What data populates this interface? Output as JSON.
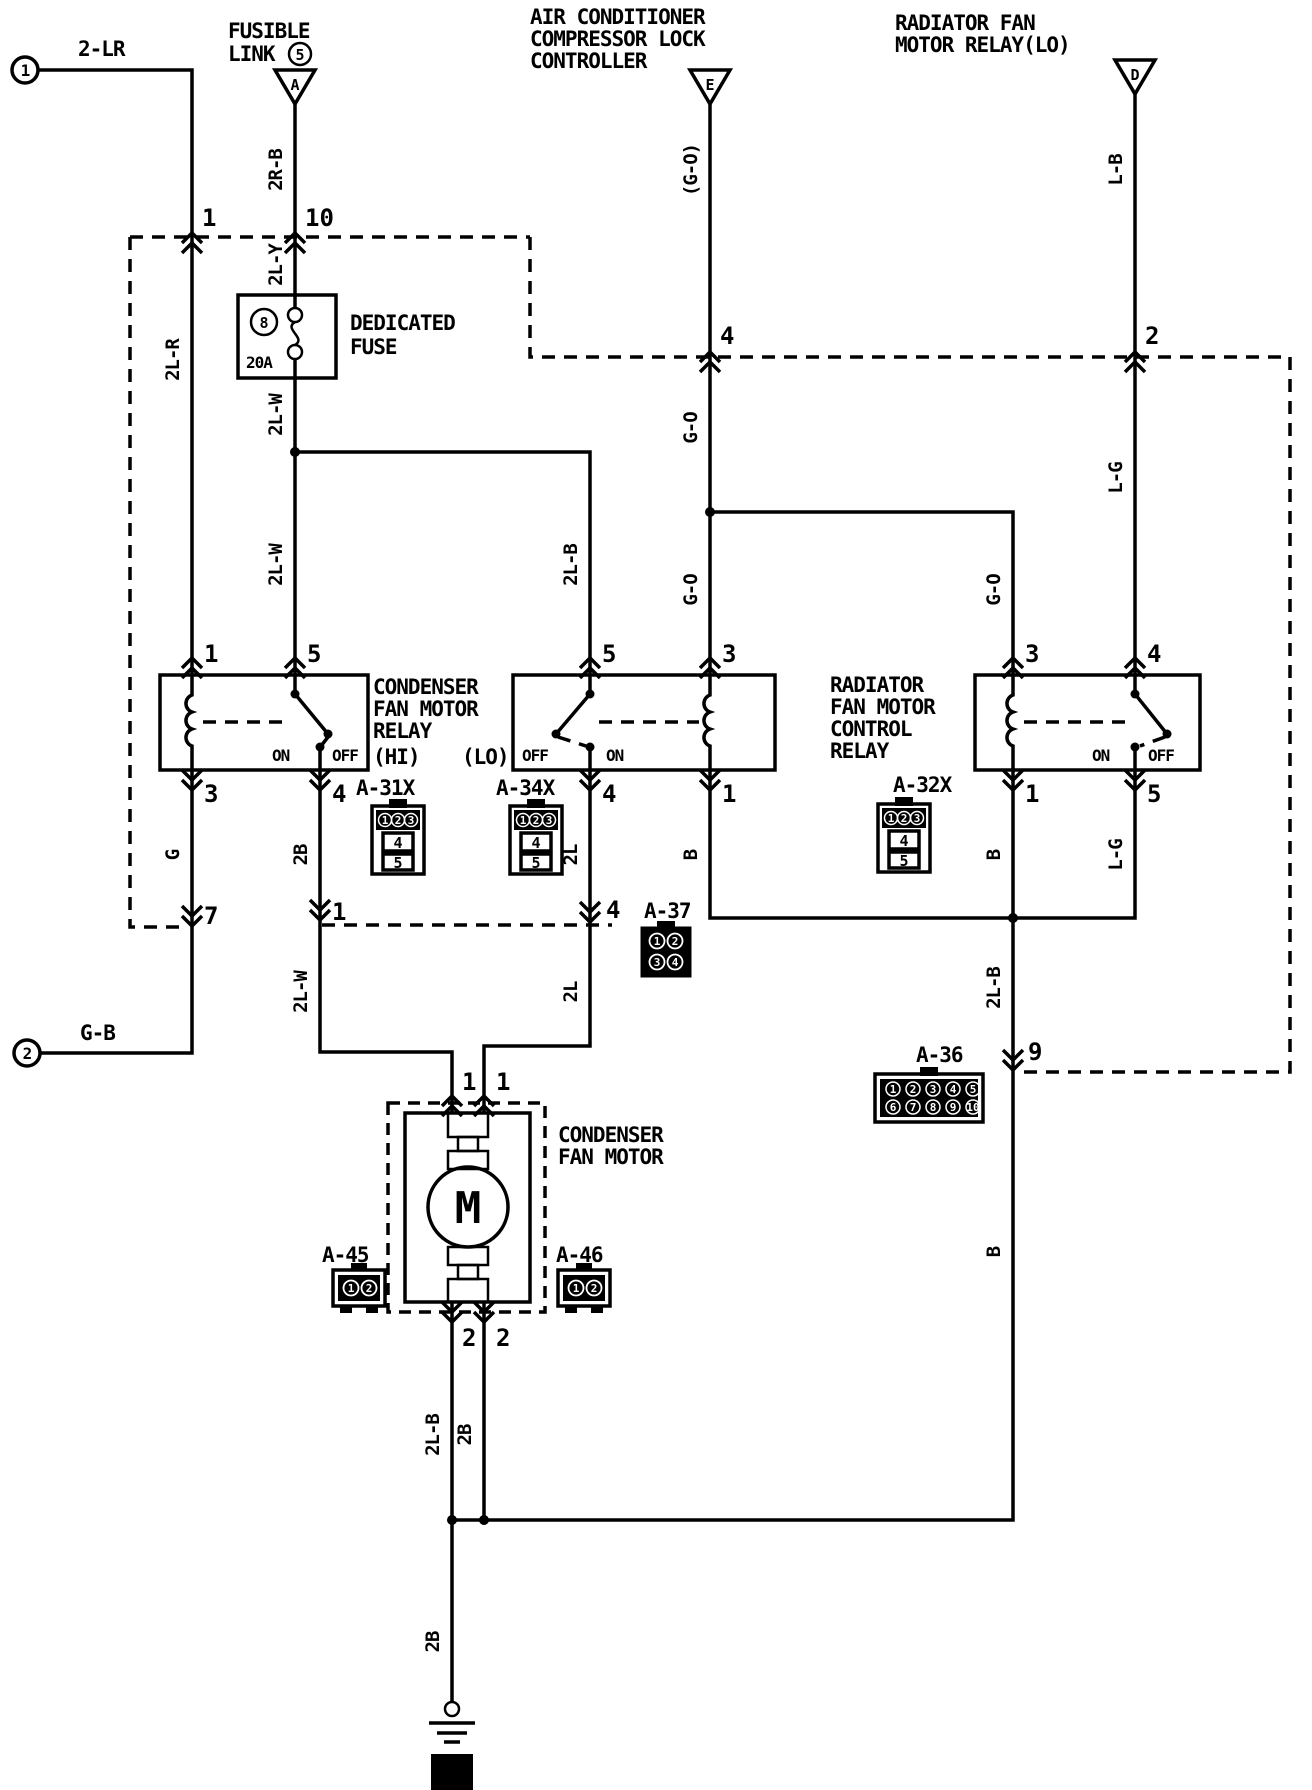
{
  "page": {
    "ref_number": "4"
  },
  "terminals": {
    "t1": "1",
    "t2": "2"
  },
  "titles": {
    "fusible_1": "FUSIBLE",
    "fusible_2": "LINK",
    "fusible_num": "5",
    "tri_a": "A",
    "ac_1": "AIR CONDITIONER",
    "ac_2": "COMPRESSOR LOCK",
    "ac_3": "CONTROLLER",
    "tri_e": "E",
    "rad_1": "RADIATOR FAN",
    "rad_2": "MOTOR RELAY(LO)",
    "tri_d": "D"
  },
  "fuse": {
    "l1": "DEDICATED",
    "l2": "FUSE",
    "num": "8",
    "amp": "20A"
  },
  "relay_condenser": {
    "l1": "CONDENSER",
    "l2": "FAN MOTOR",
    "l3": "RELAY",
    "hi": "(HI)",
    "lo": "(LO)"
  },
  "relay_radiator": {
    "l1": "RADIATOR",
    "l2": "FAN MOTOR",
    "l3": "CONTROL",
    "l4": "RELAY"
  },
  "switch_labels": {
    "on": "ON",
    "off": "OFF"
  },
  "motor": {
    "l1": "CONDENSER",
    "l2": "FAN MOTOR",
    "m": "M"
  },
  "wires": {
    "w1": "2-LR",
    "w2": "2R-B",
    "w3": "2L-Y",
    "w4": "2L-R",
    "w5": "2L-W",
    "w6": "2L-W",
    "w7": "2L-B",
    "w8": "(G-O)",
    "w9": "G-O",
    "w10": "G-O",
    "w11": "G-O",
    "w12": "L-B",
    "w13": "L-G",
    "w14": "G",
    "w15": "2B",
    "w16": "2L",
    "w17": "B",
    "w18": "B",
    "w19": "L-G",
    "w20": "2L-W",
    "w21": "2L",
    "w22": "2L-B",
    "w23": "B",
    "w24": "2L-B",
    "w25": "2B",
    "w26": "2B",
    "w27": "G-B"
  },
  "pins": {
    "t1_in": "1",
    "a_in": "10",
    "e_in": "4",
    "d_in": "2",
    "r1_1": "1",
    "r1_5": "5",
    "r2_5": "5",
    "r2_3": "3",
    "r3_3": "3",
    "r3_4": "4",
    "r1_3": "3",
    "r1_4": "4",
    "r2_4": "4",
    "r2_1": "1",
    "r3_1": "1",
    "r3_5": "5",
    "g7": "7",
    "a37_4": "4",
    "a37_left": "1",
    "a36_9": "9",
    "m1a": "1",
    "m1b": "1",
    "m2a": "2",
    "m2b": "2"
  },
  "connectors": {
    "a31x": {
      "name": "A-31X",
      "p": [
        "1",
        "2",
        "3",
        "4",
        "5"
      ]
    },
    "a34x": {
      "name": "A-34X",
      "p": [
        "1",
        "2",
        "3",
        "4",
        "5"
      ]
    },
    "a32x": {
      "name": "A-32X",
      "p": [
        "1",
        "2",
        "3",
        "4",
        "5"
      ]
    },
    "a37": {
      "name": "A-37",
      "p": [
        "1",
        "2",
        "3",
        "4"
      ]
    },
    "a36": {
      "name": "A-36",
      "r1": [
        "1",
        "2",
        "3",
        "4",
        "5"
      ],
      "r2": [
        "6",
        "7",
        "8",
        "9",
        "10"
      ]
    },
    "a45": {
      "name": "A-45",
      "p": [
        "1",
        "2"
      ]
    },
    "a46": {
      "name": "A-46",
      "p": [
        "1",
        "2"
      ]
    }
  }
}
